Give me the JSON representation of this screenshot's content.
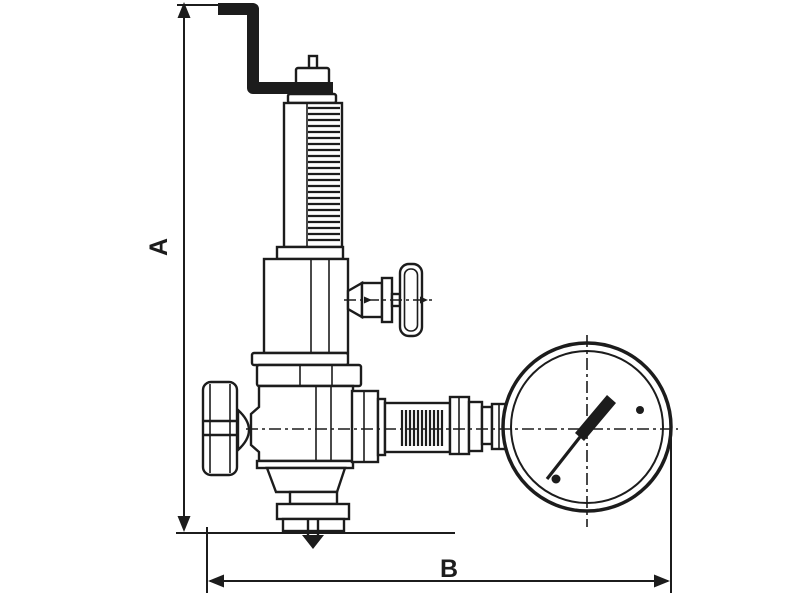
{
  "drawing": {
    "type": "valve-with-pressure-gauge-technical-diagram",
    "line_color": "#1c1c1c",
    "background_color": "#ffffff"
  },
  "dimensions": {
    "height_label": "A",
    "width_label": "B"
  }
}
